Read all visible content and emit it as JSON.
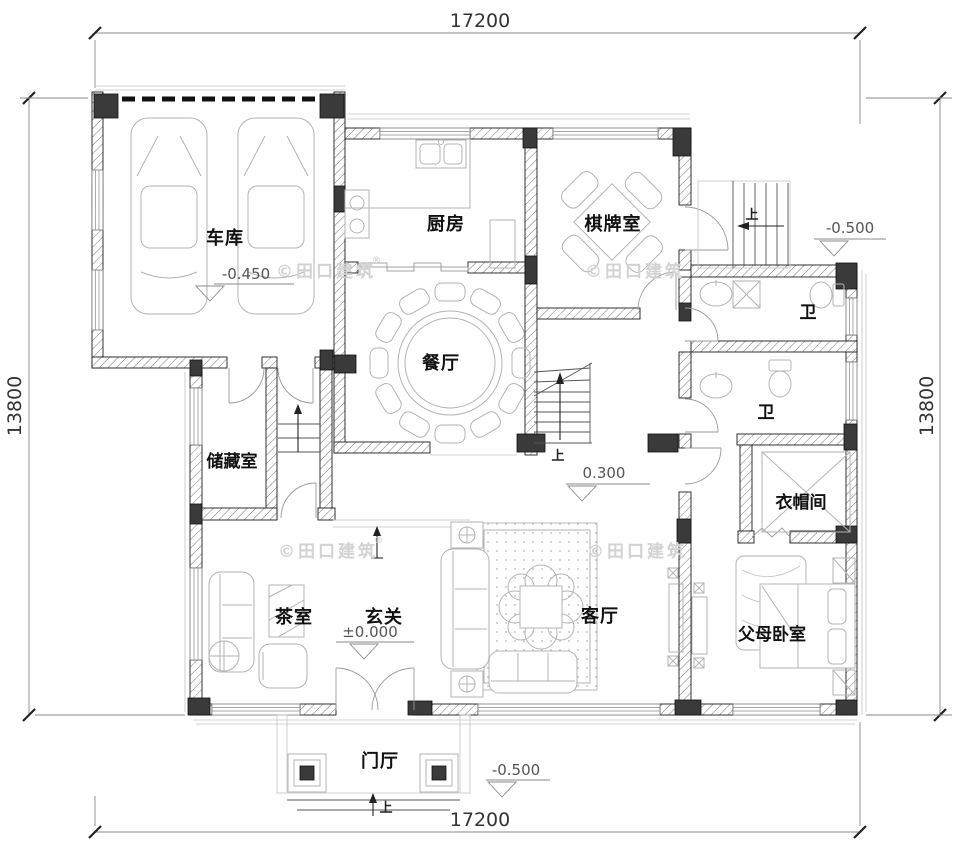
{
  "dimensions": {
    "top": "17200",
    "bottom": "17200",
    "left": "13800",
    "right": "13800"
  },
  "rooms": {
    "garage": {
      "label": "车库"
    },
    "kitchen": {
      "label": "厨房"
    },
    "game_room": {
      "label": "棋牌室"
    },
    "dining_room": {
      "label": "餐厅"
    },
    "bath_upper": {
      "label": "卫"
    },
    "bath_lower": {
      "label": "卫"
    },
    "storage": {
      "label": "储藏室"
    },
    "cloakroom": {
      "label": "衣帽间"
    },
    "tea_room": {
      "label": "茶室"
    },
    "foyer": {
      "label": "玄关"
    },
    "living_room": {
      "label": "客厅"
    },
    "parents_bedroom": {
      "label": "父母卧室"
    },
    "porch": {
      "label": "门厅"
    }
  },
  "elevations": {
    "garage": "-0.450",
    "terrace": "-0.500",
    "main_floor": "0.300",
    "foyer": "±0.000",
    "porch": "-0.500"
  },
  "stairs": {
    "up": "上"
  },
  "watermark": {
    "text": "©田口建筑",
    "reg": "®"
  },
  "colors": {
    "wall": "#1a1a1a",
    "column": "#3a3a3a",
    "furniture": "#b3b3b3",
    "watermark": "#d2d2d2"
  }
}
